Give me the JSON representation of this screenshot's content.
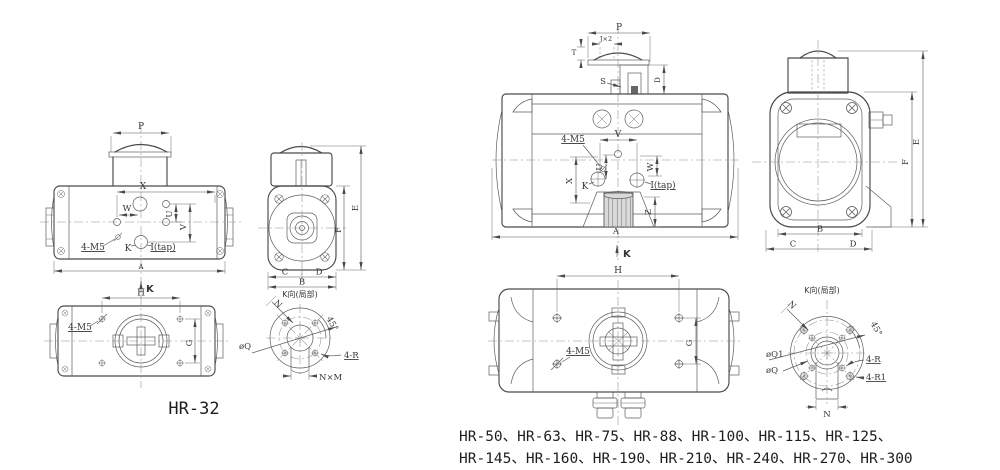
{
  "views": {
    "left_top": {
      "p": "P"
    },
    "left_front": {
      "x": "X",
      "w": "W",
      "u": "U",
      "v": "V",
      "m5": "4-M5",
      "k": "K",
      "itap": "I(tap)",
      "a": "A",
      "k_arrow": "K"
    },
    "left_side": {
      "e": "E",
      "f": "F",
      "c": "C",
      "d": "D",
      "b": "B"
    },
    "left_bottom": {
      "h": "H",
      "m5": "4-M5",
      "g": "G"
    },
    "left_kview": {
      "title": "K向(局部)",
      "n": "N",
      "angle": "45°",
      "q": "øQ",
      "r": "4-R",
      "nxm": "N×M"
    },
    "right_top": {
      "p": "P",
      "j": "J×2",
      "t": "T",
      "s": "S",
      "d": "D"
    },
    "right_front": {
      "m5": "4-M5",
      "v": "V",
      "u": "U",
      "x": "X",
      "w": "W",
      "k": "K",
      "itap": "I(tap)",
      "z": "Z",
      "a": "A",
      "k_arrow": "K"
    },
    "right_side": {
      "e": "E",
      "f": "F",
      "b": "B",
      "c": "C",
      "d": "D"
    },
    "right_bottom": {
      "h": "H",
      "m5": "4-M5",
      "g": "G"
    },
    "right_kview": {
      "title": "K向(局部)",
      "n": "N",
      "angle": "45°",
      "q1": "øQ1",
      "q": "øQ",
      "r": "4-R",
      "r1": "4-R1",
      "n_bottom": "N"
    }
  },
  "captions": {
    "left_model": "HR-32",
    "right_models_line1": "HR-50、HR-63、HR-75、HR-88、HR-100、HR-115、HR-125、",
    "right_models_line2": "HR-145、HR-160、HR-190、HR-210、HR-240、HR-270、HR-300"
  },
  "colors": {
    "line": "#4a4a4a",
    "thin": "#5d5d5d",
    "centerline": "#8f8f8f",
    "text": "#363636",
    "background": "#ffffff"
  }
}
